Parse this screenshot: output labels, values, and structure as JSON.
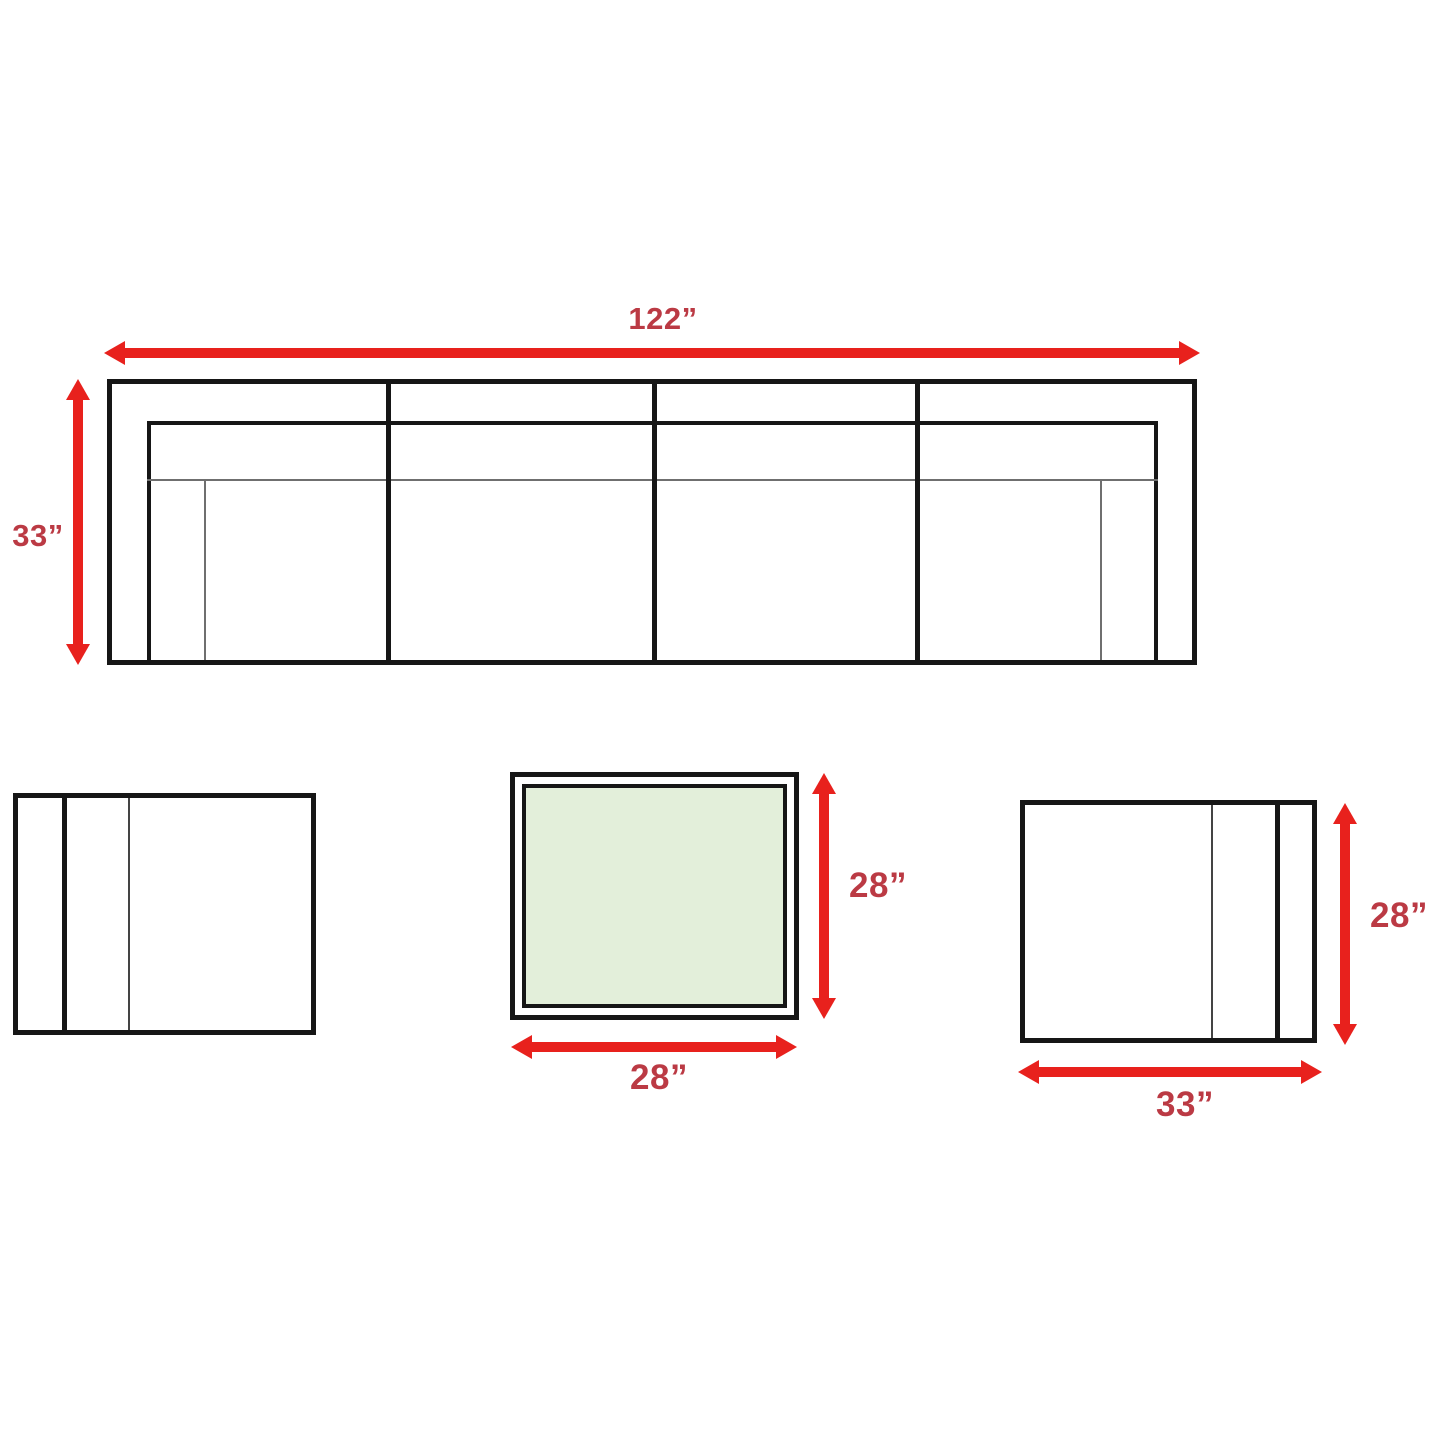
{
  "diagram": {
    "type": "furniture-dimension-top-view",
    "colors": {
      "arrow_red": "#e8211d",
      "label_red": "#bb3a44",
      "outline_black": "#161616",
      "thin_line_gray": "#6f6f6f",
      "table_top_green": "#e3efda",
      "background": "#ffffff"
    },
    "sofa": {
      "name": "sofa-top-view",
      "width_label": "122”",
      "depth_label": "33”",
      "seat_sections": 4
    },
    "left_chair": {
      "name": "left-chair-top-view"
    },
    "coffee_table": {
      "name": "coffee-table-top-view",
      "depth_label": "28”",
      "width_label": "28”"
    },
    "right_chair": {
      "name": "right-chair-top-view",
      "depth_label": "28”",
      "width_label": "33”"
    }
  }
}
